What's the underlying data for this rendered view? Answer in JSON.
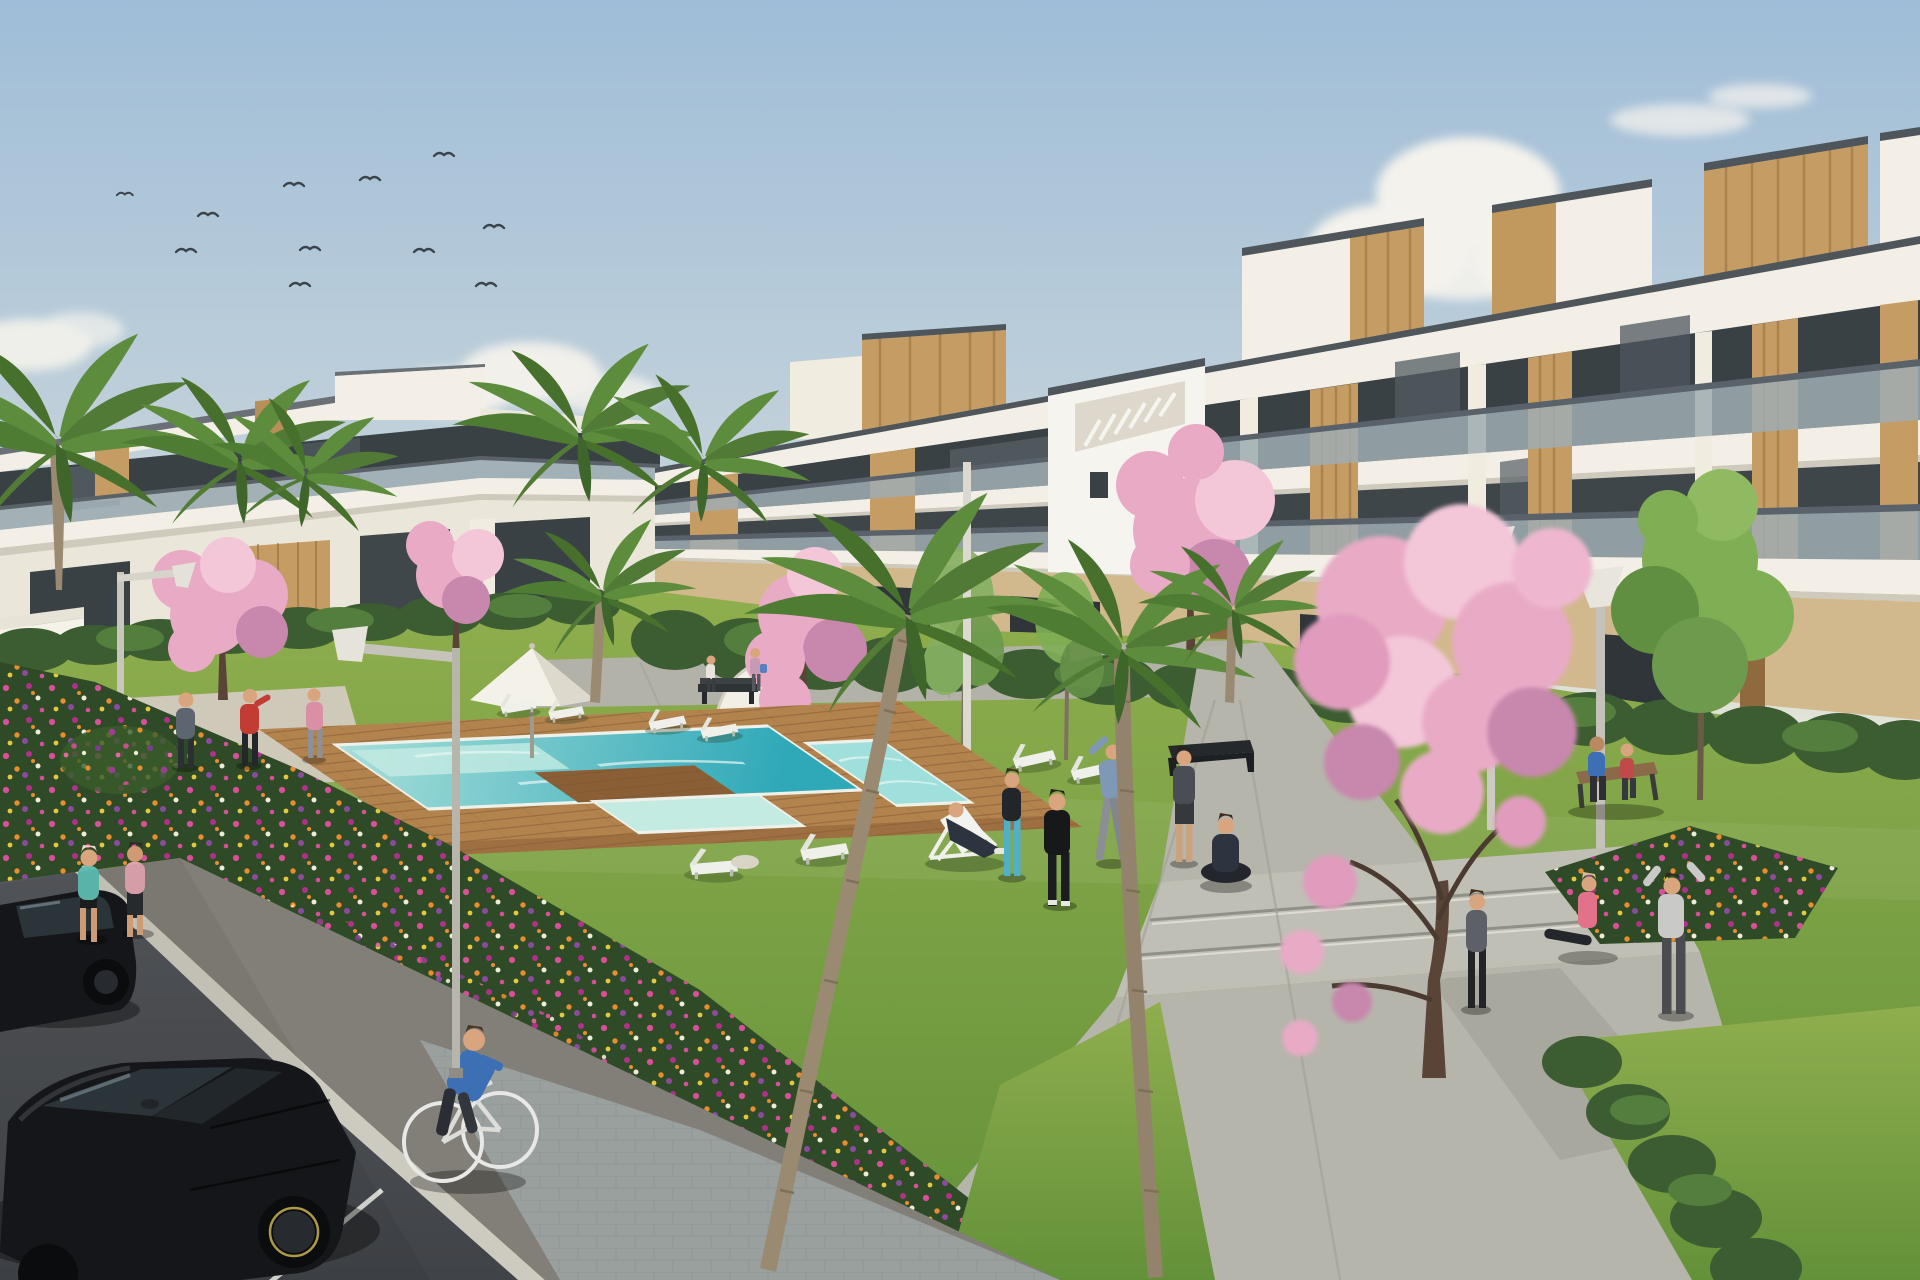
{
  "scene": {
    "type": "architectural-render",
    "description": "Sunny 3D rendering of a modern white apartment complex with wood-clad accents, a communal turquoise pool on a timber deck, lawns with exercising residents, pink blossom trees, palm trees, flower beds, concrete paths and a parking lot with two black cars, a cyclist and joggers under a blue sky with a flock of birds.",
    "counts": {
      "buildings": 2,
      "birds": 11,
      "cloud_clusters": 4,
      "palm_crowns": 9,
      "blossom_trees": 5,
      "green_trees": 3,
      "sun_loungers": 9,
      "deck_chairs": 1,
      "parasols": 1,
      "street_lamps": 4,
      "benches": 3,
      "people": 19,
      "cars": 2,
      "bicycles": 1,
      "pools": 3
    }
  },
  "palette": {
    "sky_top": "#9fbdd8",
    "sky_mid": "#c3d2da",
    "sky_horizon": "#e6e5d8",
    "cloud": "#f4f2ec",
    "bird": "#3a434c",
    "building_white": "#f3efe6",
    "building_shade": "#e0dccf",
    "coping_dark": "#4e565c",
    "glass_dark": "#3a4145",
    "glass_balustrade": "#9fadb2",
    "wood_panel": "#c59c63",
    "wood_dark": "#8f6a3e",
    "stucco_tan": "#d2b88d",
    "hedge": "#3c5c31",
    "hedge_light": "#547e3d",
    "lawn_far": "#8fae4e",
    "lawn_near": "#639139",
    "bed_green": "#2f4a26",
    "deck_wood": "#b3834e",
    "deck_wood_dark": "#8a5f36",
    "pool_far": "#a8dfd9",
    "pool_near": "#2fa8b8",
    "pool_shallow": "#c4ebe2",
    "pool_rim": "#eef1ea",
    "walkway": "#b3b2a8",
    "path_concrete": "#b6b5ab",
    "path_shade": "#9fa096",
    "jogger_path": "#827f78",
    "plaza_paver": "#9aa09e",
    "asphalt": "#404347",
    "stall_line": "#d9dcd6",
    "blossom_pink": "#e9aac6",
    "blossom_light": "#f3c6d8",
    "blossom_deep": "#c887ad",
    "palm_green": "#5d8c3d",
    "palm_dark": "#46702c",
    "trunk": "#9b8a72",
    "tree_trunk": "#5a4438",
    "flower_magenta": "#c6417f",
    "flower_orange": "#df8c2e",
    "flower_purple": "#8a4b9e",
    "flower_white": "#efe9d6",
    "skin": "#d9a57e",
    "car_black": "#16181b",
    "lounger_white": "#eef0e9"
  }
}
